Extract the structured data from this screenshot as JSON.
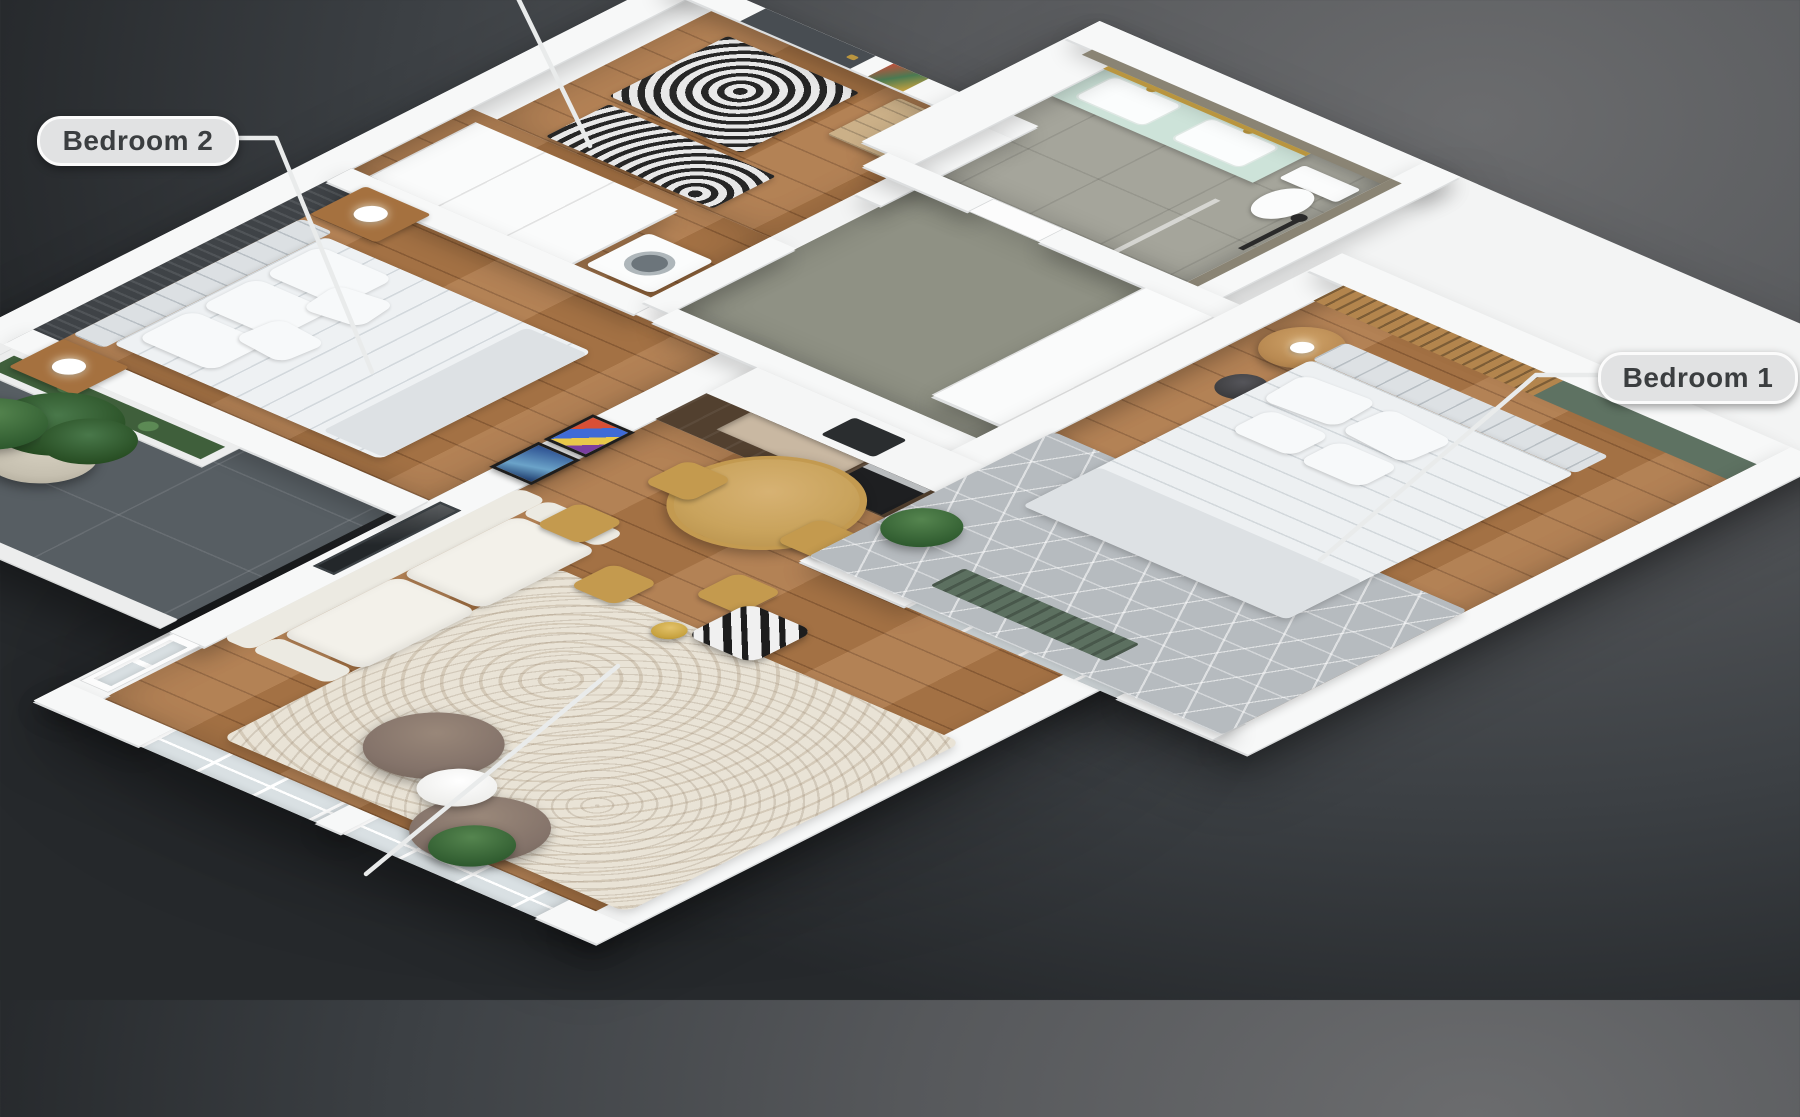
{
  "scene": {
    "type": "isometric-3d-floor-plan",
    "description": "3D isometric render of a two-bedroom apartment interior on a dark slate background",
    "background_top_right": "#6b6c6e",
    "background_bottom_left": "#26292c"
  },
  "annotations": {
    "bedroom2": {
      "label": "Bedroom 2"
    },
    "bedroom1": {
      "label": "Bedroom 1"
    },
    "pill_background": "#e1e2e3",
    "pill_border": "#fbfbfb",
    "pill_text_color": "#3b3e40",
    "leader_line_color": "#e9ebeb",
    "partial_leader_lines": [
      "top-edge-line",
      "bottom-edge-line"
    ]
  },
  "rooms": [
    {
      "name": "Bedroom 2",
      "features": [
        "double-bed",
        "tufted-headboard",
        "dark-slat-accent-wall",
        "two-wood-nightstands",
        "white-table-lamps",
        "wood-floor"
      ]
    },
    {
      "name": "Bedroom 1",
      "features": [
        "double-bed",
        "wood-slat-accent-wall",
        "green-accent-wall",
        "hex-pattern-gray-rug",
        "round-wood-side-table",
        "black-stool",
        "potted-plant",
        "window-with-green-curtain",
        "wood-floor"
      ]
    },
    {
      "name": "Living Room",
      "features": [
        "white-sofa",
        "cream-speckled-rug",
        "two-taupe-armchairs",
        "round-white-side-table",
        "black-white-patterned-accent-chair",
        "gold-floor-lamp",
        "tv-wall-niche",
        "two-framed-artworks",
        "balcony-door",
        "windows",
        "plant",
        "wood-floor"
      ]
    },
    {
      "name": "Dining Area",
      "features": [
        "round-oak-table",
        "five-oak-chairs"
      ]
    },
    {
      "name": "Kitchen",
      "features": [
        "walnut-cabinets",
        "white-countertop",
        "oven",
        "black-cooktop",
        "backsplash-niche"
      ]
    },
    {
      "name": "Bathroom",
      "features": [
        "mint-double-vanity",
        "two-white-sinks",
        "gold-faucets",
        "toilet",
        "shower-glass",
        "black-shower-fixture",
        "gold-trim",
        "olive-walls",
        "tile-floor"
      ]
    },
    {
      "name": "Entry Hall",
      "features": [
        "dark-front-door",
        "wood-slat-bench",
        "two-black-white-circle-rugs",
        "colorful-coat-art"
      ]
    },
    {
      "name": "Corridor",
      "features": [
        "olive-walls",
        "white-built-in-closets",
        "bathroom-door"
      ]
    },
    {
      "name": "Dressing Laundry",
      "features": [
        "white-wardrobe",
        "washing-machine"
      ]
    },
    {
      "name": "Balcony",
      "features": [
        "dark-tile-floor",
        "white-planter-box",
        "potted-green-plant",
        "low-parapet"
      ]
    }
  ],
  "palette": {
    "wall_white": "#f7f8f8",
    "wood_floor": "#ad7848",
    "accent_dark_wall": "#3f4347",
    "olive_wall": "#8a8474",
    "mint_vanity": "#cde3d9",
    "walnut_kitchen": "#52402f",
    "oak_dining": "#c9a35c",
    "green_wall": "#5e7262",
    "wood_slat_wall": "#b3854d",
    "gold_accent": "#b9953f",
    "cream_rug": "#e9e3d6",
    "taupe_chair": "#84736a",
    "balcony_tile": "#5a6166",
    "bed_linen": "#eef1f3",
    "hex_rug": "#b6bbbf"
  }
}
